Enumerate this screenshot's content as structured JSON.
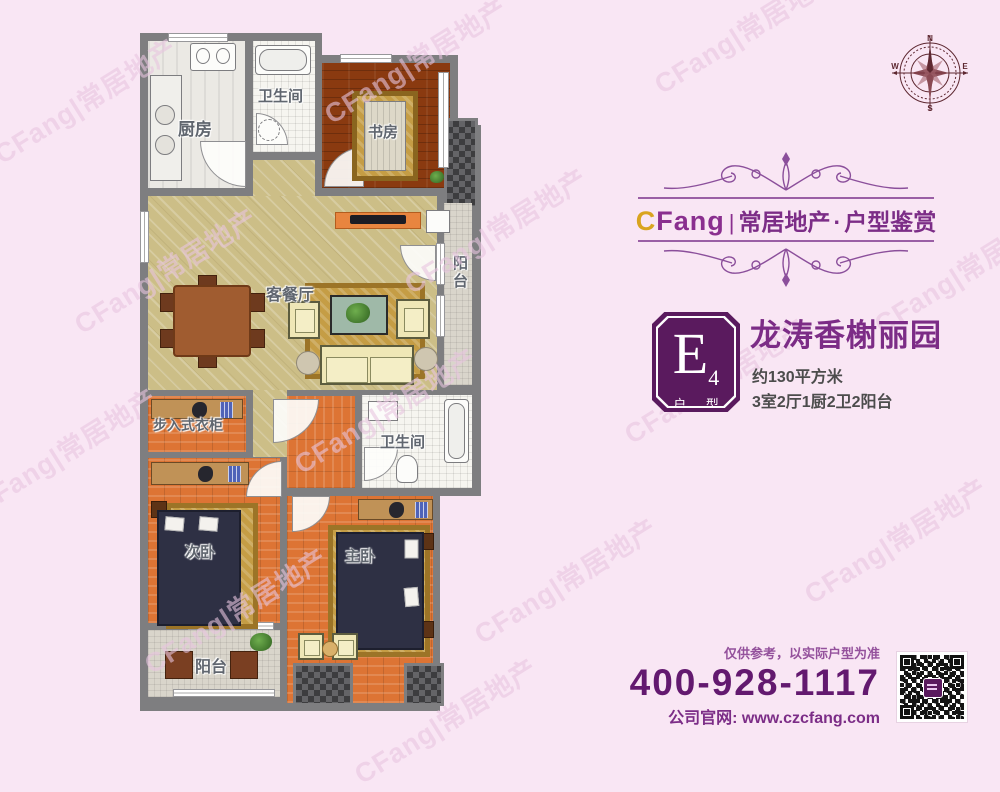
{
  "watermark": {
    "text": "CFang|常居地产"
  },
  "compass": {
    "n": "N",
    "e": "E",
    "s": "S",
    "w": "W"
  },
  "brand": {
    "logo_latin_c": "C",
    "logo_latin_rest": "Fang",
    "separator": "|",
    "name_cn": "常居地产",
    "dot": "·",
    "tagline": "户型鉴赏",
    "purple": "#8a2f8f",
    "gold": "#d9a41f"
  },
  "unit": {
    "badge_letter": "E",
    "badge_number": "4",
    "badge_caption": "户 型",
    "badge_color": "#5a1a5e",
    "title": "龙涛香榭丽园",
    "area": "约130平方米",
    "rooms_summary": "3室2厅1厨2卫2阳台"
  },
  "contact": {
    "disclaimer": "仅供参考，以实际户型为准",
    "phone": "400-928-1117",
    "website_label": "公司官网: ",
    "website_url": "www.czcfang.com"
  },
  "floorplan": {
    "rooms": [
      {
        "id": "kitchen",
        "label": "厨房"
      },
      {
        "id": "bathroom-top",
        "label": "卫生间"
      },
      {
        "id": "study",
        "label": "书房"
      },
      {
        "id": "living-dining",
        "label": "客餐厅"
      },
      {
        "id": "balcony-right",
        "label": "阳台"
      },
      {
        "id": "walk-in-closet",
        "label": "步入式衣柜"
      },
      {
        "id": "bathroom-middle",
        "label": "卫生间"
      },
      {
        "id": "bedroom-second",
        "label": "次卧"
      },
      {
        "id": "bedroom-master",
        "label": "主卧"
      },
      {
        "id": "balcony-bottom",
        "label": "阳台"
      }
    ]
  }
}
